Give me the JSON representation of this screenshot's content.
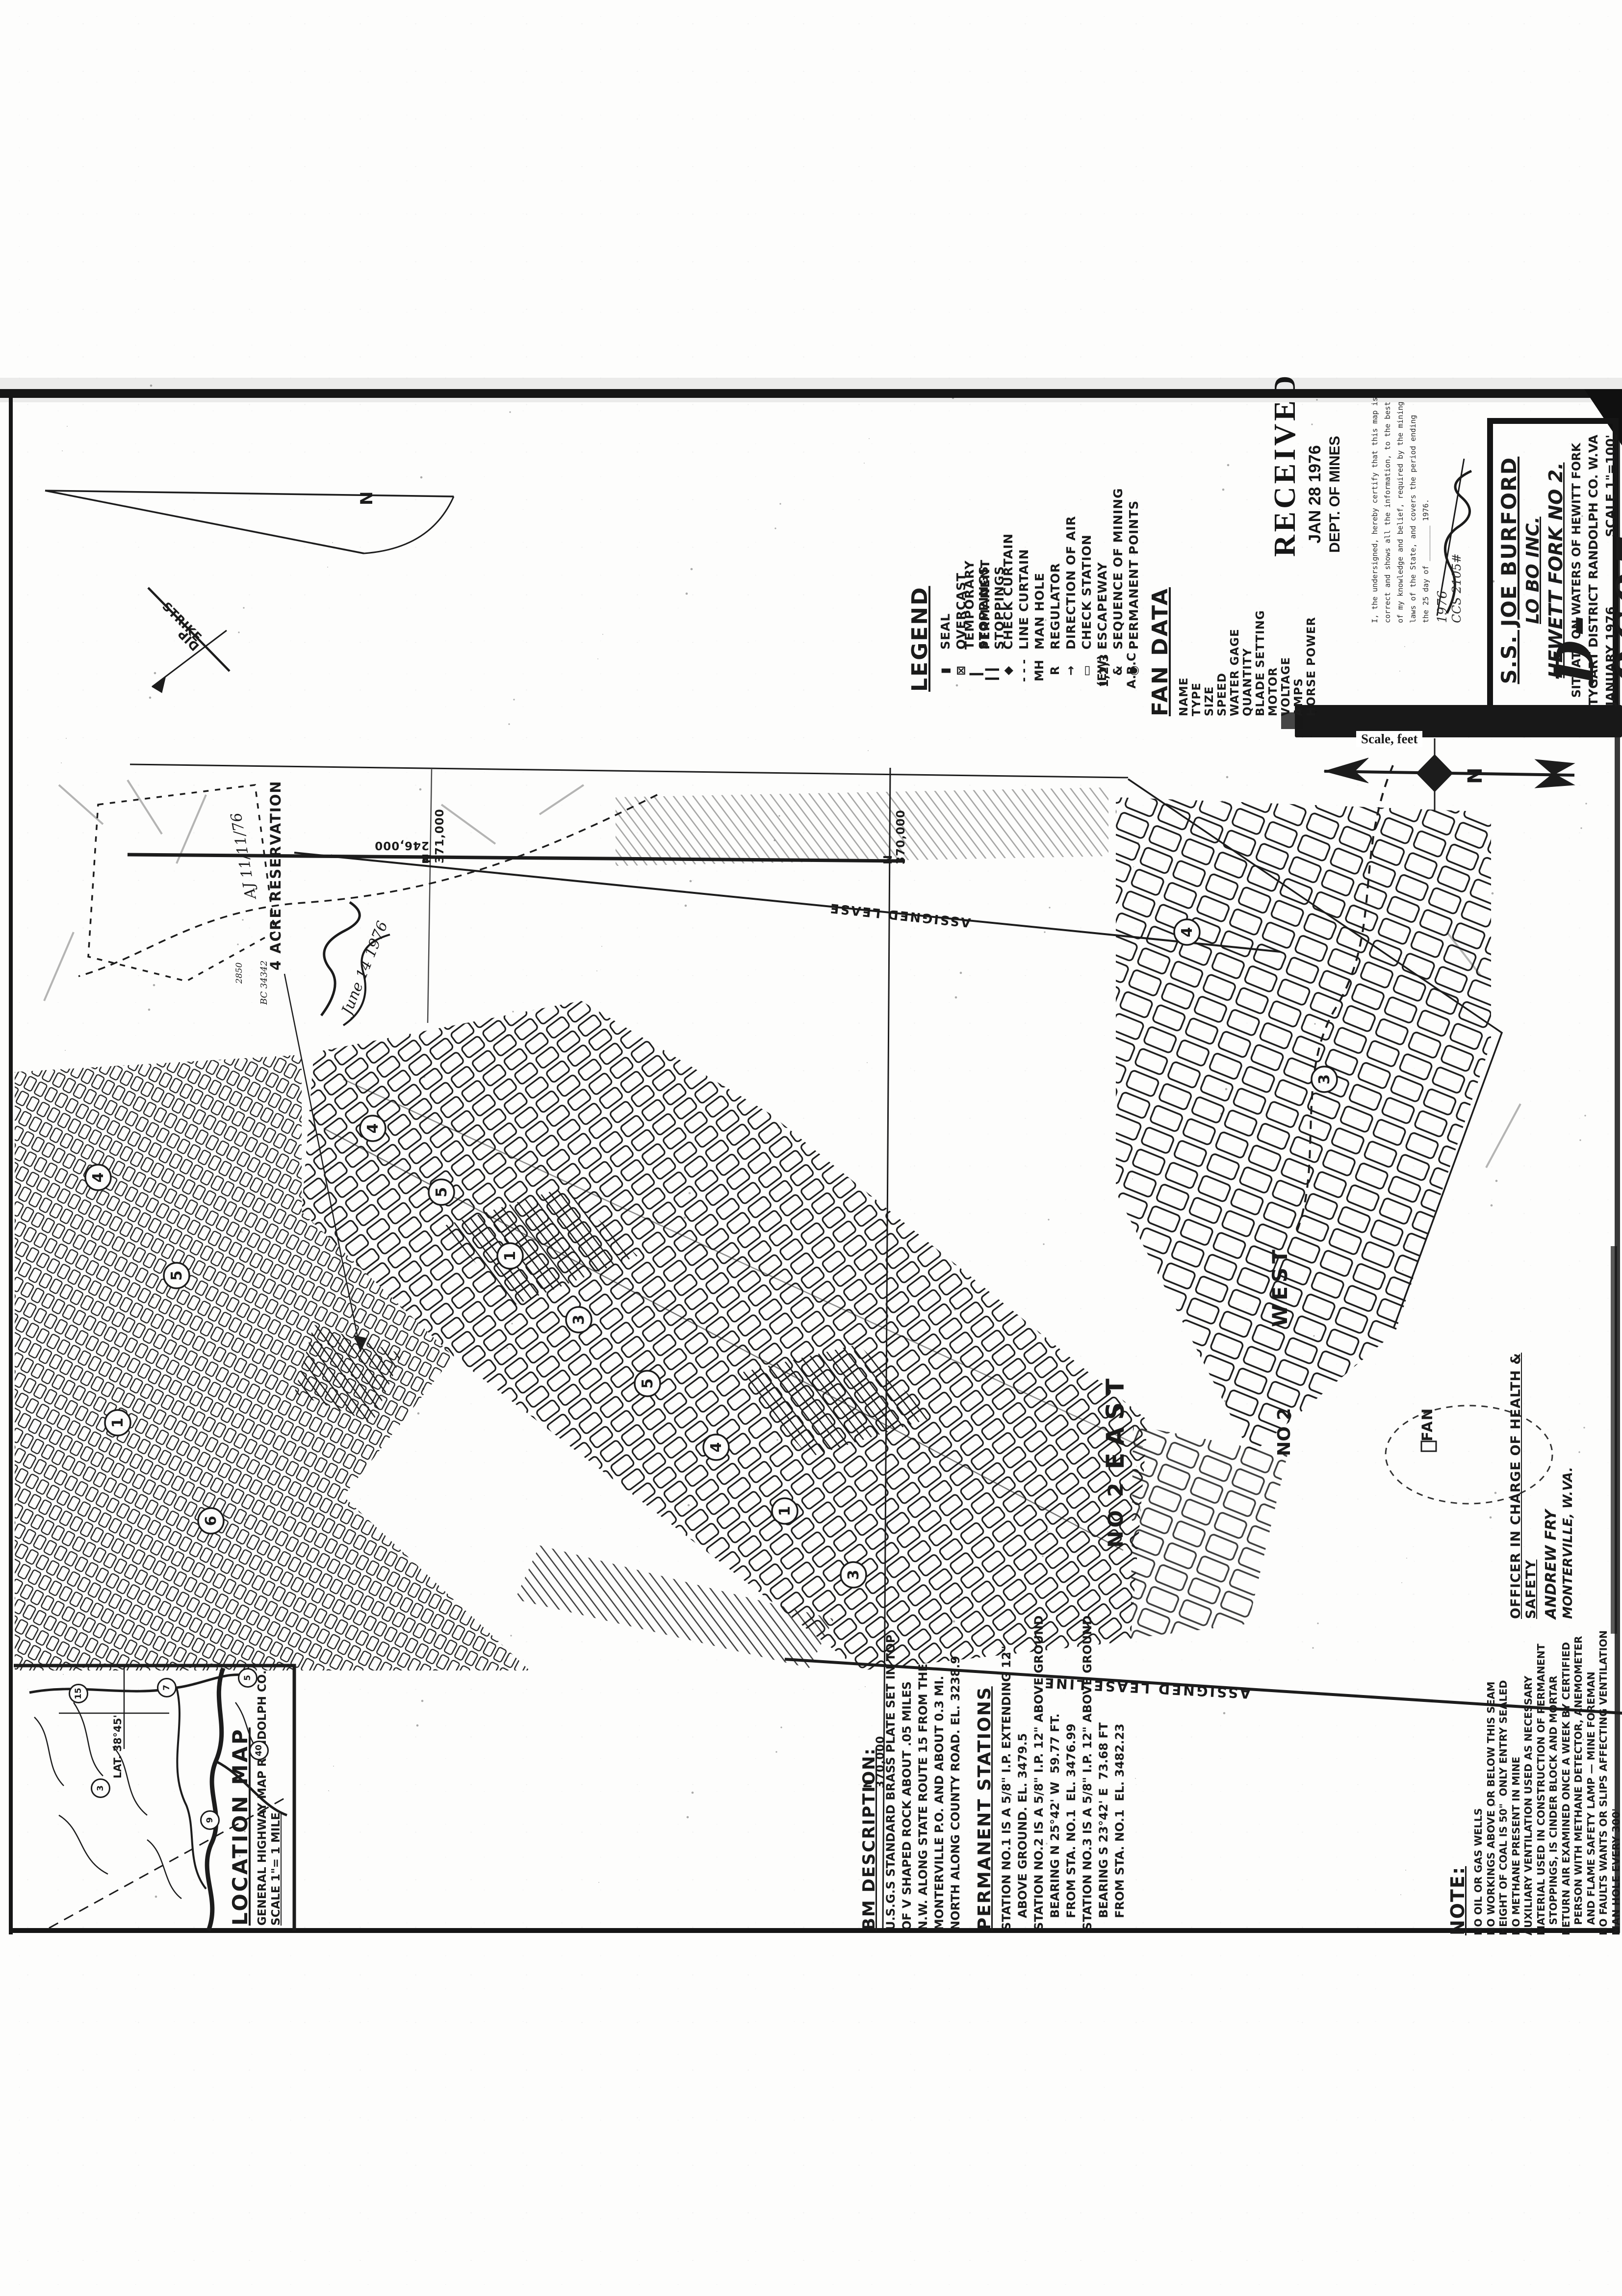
{
  "stamps": {
    "received": {
      "line1": "RECEIVED",
      "line2": "JAN 28 1976",
      "line3": "DEPT. OF MINES"
    },
    "certification": {
      "lines": [
        "I, the undersigned, hereby certify that this map is",
        "correct and shows all the information, to the best",
        "of my knowledge and belief, required by the mining",
        "laws of the State, and covers the period ending",
        "the 25 day of ________ 1976."
      ],
      "year_hand": "1976",
      "signature_suffix": "CCS 2105#"
    }
  },
  "title_block": {
    "company": "S.S. JOE BURFORD",
    "operator": "LO BO INC.",
    "mine": "HEWETT FORK NO 2.",
    "situate": "SITUATE ON WATERS OF HEWITT FORK",
    "district": "TYGART DISTRICT",
    "county": "RANDOLPH CO. W.VA",
    "date": "JANUARY 1976",
    "scale": "SCALE 1\"=100'",
    "engineer": "— R. H. DUNLAP —",
    "drawing_number": "D-9605"
  },
  "legend": {
    "title": "LEGEND",
    "items": [
      {
        "icon": "seal-icon",
        "glyph": "▮",
        "label": "SEAL"
      },
      {
        "icon": "overcast-icon",
        "glyph": "⊠",
        "label": "OVERCAST"
      },
      {
        "icon": "temporary-stopping-icon",
        "glyph": "▎",
        "label": "TEMPORARY STOPPINGS"
      },
      {
        "icon": "permanent-stopping-icon",
        "glyph": "▎▎",
        "label": "PERMANENT STOPPINGS"
      },
      {
        "icon": "check-curtain-icon",
        "glyph": "◆",
        "label": "CHECK CURTAIN"
      },
      {
        "icon": "line-curtain-icon",
        "glyph": "- - -",
        "label": "LINE CURTAIN"
      },
      {
        "icon": "man-hole-icon",
        "glyph": "MH",
        "label": "MAN HOLE"
      },
      {
        "icon": "regulator-icon",
        "glyph": "R",
        "label": "REGULATOR"
      },
      {
        "icon": "direction-of-air-icon",
        "glyph": "→",
        "label": "DIRECTION OF AIR"
      },
      {
        "icon": "check-station-icon",
        "glyph": "▭",
        "label": "CHECK STATION"
      },
      {
        "icon": "escapeway-icon",
        "glyph": "(EW)",
        "label": "ESCAPEWAY"
      },
      {
        "icon": "sequence-of-mining-icon",
        "glyph": "1,2,3 & A.B.C",
        "label": "SEQUENCE OF MINING"
      },
      {
        "icon": "permanent-points-icon",
        "glyph": "◉",
        "label": "PERMANENT POINTS"
      }
    ]
  },
  "fan_data": {
    "title": "FAN DATA",
    "items": [
      "NAME",
      "TYPE",
      "SIZE",
      "SPEED",
      "WATER GAGE",
      "QUANTITY",
      "BLADE SETTING",
      "MOTOR",
      "VOLTAGE",
      "AMPS",
      "HORSE POWER"
    ]
  },
  "scale_bar": {
    "caption": "Scale, feet"
  },
  "north_arrow": {
    "letter": "N"
  },
  "declination": {
    "letter": "N"
  },
  "strike_dip": {
    "strike": "STRIKE",
    "dip": "DIP"
  },
  "bm_description": {
    "title": "BM DESCRIPTION:",
    "lines": [
      "U.S.G.S STANDARD BRASS PLATE SET IN TOP",
      "OF V SHAPED ROCK ABOUT .05 MILES",
      "N.W. ALONG STATE ROUTE 15 FROM THE",
      "MONTERVILLE P.O. AND ABOUT 0.3 MI.",
      "NORTH ALONG COUNTY ROAD. EL. 3238.9"
    ]
  },
  "permanent_stations": {
    "title": "PERMANENT STATIONS",
    "lines": [
      "STATION NO.1 IS A 5/8\" I.P. EXTENDING 12\"",
      "   ABOVE GROUND. EL. 3479.5",
      "STATION NO.2 IS A 5/8\" I.P. 12\" ABOVE GROUND",
      "   BEARING N 25°42' W  59.77 FT.",
      "   FROM STA. NO.1  EL. 3476.99",
      "STATION NO.3 IS A 5/8\" I.P. 12\" ABOVE GROUND",
      "   BEARING S 23°42' E  73.68 FT",
      "   FROM STA. NO.1  EL. 3482.23"
    ]
  },
  "note": {
    "title": "NOTE:",
    "lines": [
      "NO OIL OR GAS WELLS",
      "NO WORKINGS ABOVE OR BELOW THIS SEAM",
      "HEIGHT OF COAL IS 50\"  ONLY ENTRY SEALED",
      "NO METHANE PRESENT IN MINE",
      "AUXILIARY VENTILATION USED AS NECESSARY",
      "MATERIAL USED IN CONSTRUCTION OF PERMANENT",
      "   STOPPINGS, IS CINDER BLOCK AND MORTAR",
      "RETURN AIR EXAMINED ONCE A WEEK BY CERTIFIED",
      "   PERSON WITH METHANE DETECTOR, ANEMOMETER",
      "   AND FLAME SAFETY LAMP — MINE FOREMAN",
      "NO FAULTS WANTS OR SLIPS AFFECTING VENTILATION",
      "MAN HOLE EVERY 300'"
    ]
  },
  "officer": {
    "title": "OFFICER IN CHARGE OF HEALTH & SAFETY",
    "name": "ANDREW FRY",
    "place": "MONTERVILLE, W.VA."
  },
  "location_map": {
    "title": "LOCATION MAP",
    "subtitle": "GENERAL HIGHWAY MAP RANDOLPH CO.",
    "scale": "SCALE 1\"= 1 MILE",
    "lat_label": "LAT. 38°45'",
    "route_badges": [
      "15",
      "7",
      "5",
      "9",
      "3",
      "40"
    ]
  },
  "grid_labels": {
    "n370": "N 370,000",
    "n371": "N 371,000",
    "e246": "E 246,000"
  },
  "map_labels": {
    "reservation": "4 ACRE RESERVATION",
    "lease_top": "ASSIGNED LEASE",
    "lease_bottom": "ASSIGNED LEASE LINE",
    "east": "EAST",
    "no2": "NO 2",
    "west": "WEST",
    "fan": "FAN",
    "hand_initials": "AJ  11/11/76",
    "hand_bc": "BC 34342",
    "hand_el": "2850",
    "approval_date": "June 14 1976"
  },
  "map_overlay": {
    "sequence_numbers": [
      "4",
      "5",
      "1",
      "3",
      "5",
      "4",
      "1",
      "3",
      "4",
      "5",
      "1",
      "6",
      "4",
      "3"
    ]
  },
  "colors": {
    "ink": "#1b1b1b",
    "paper": "#fdfdfc"
  }
}
